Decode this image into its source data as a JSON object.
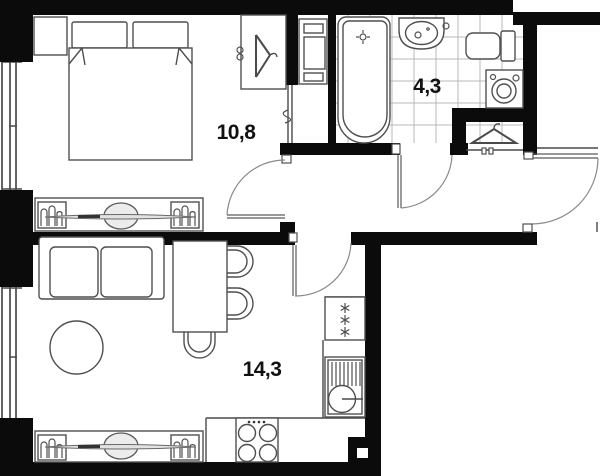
{
  "plan": {
    "type": "apartment-floor-plan",
    "rooms": [
      {
        "id": "bedroom",
        "area_label": "10,8"
      },
      {
        "id": "bathroom",
        "area_label": "4,3"
      },
      {
        "id": "living-kitchen",
        "area_label": "14,3"
      }
    ],
    "colors": {
      "wall": "#0b0b0b",
      "line": "#4a4a4a",
      "tile_grid": "#b9b9b9",
      "background": "#ffffff",
      "label": "#111111"
    }
  }
}
